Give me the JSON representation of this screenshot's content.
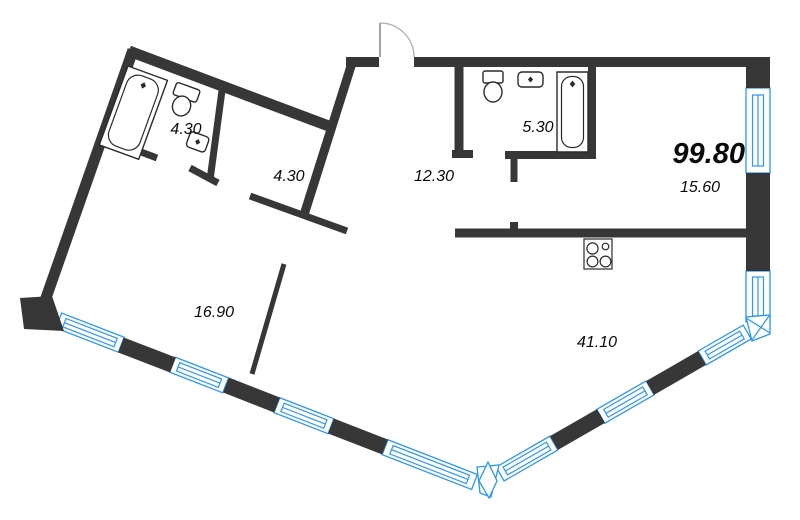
{
  "floor_plan": {
    "total_area": "99.80",
    "rooms": [
      {
        "id": "bathroom-top-left",
        "area": "4.30"
      },
      {
        "id": "hallway",
        "area": "4.30"
      },
      {
        "id": "entrance-hall",
        "area": "12.30"
      },
      {
        "id": "bathroom-top-right",
        "area": "5.30"
      },
      {
        "id": "kitchen-area",
        "area": "15.60"
      },
      {
        "id": "room-left",
        "area": "16.90"
      },
      {
        "id": "living-area",
        "area": "41.10"
      }
    ],
    "fixtures": [
      "bathtub",
      "toilet",
      "sink",
      "bathtub",
      "toilet",
      "sink",
      "stove"
    ],
    "colors": {
      "wall": "#373737",
      "window": "#2b97f1",
      "fixture": "#2a2a2a",
      "label": "#0a0a0a",
      "door": "#adadad",
      "bg": "#ffffff"
    }
  }
}
